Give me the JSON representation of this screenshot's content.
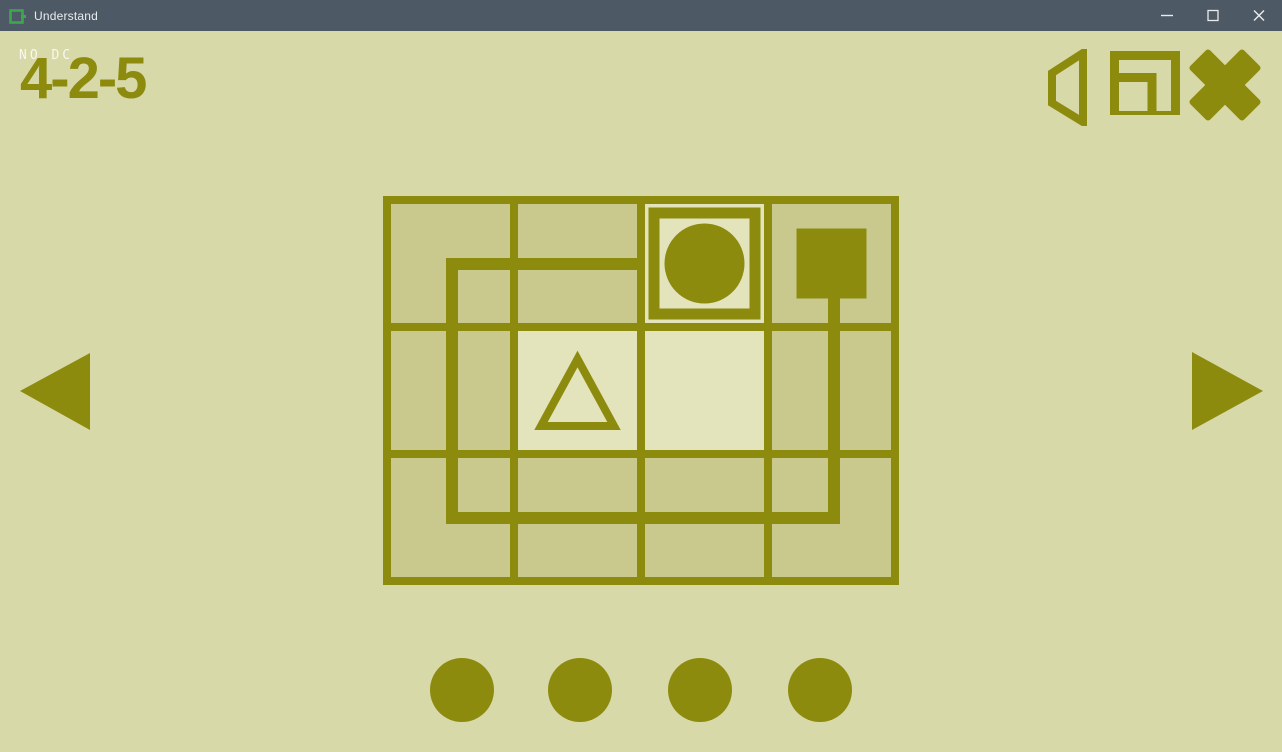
{
  "window": {
    "title": "Understand",
    "app_icon": "understand-logo-icon",
    "controls": [
      {
        "name": "minimize-button",
        "icon": "minimize-icon"
      },
      {
        "name": "maximize-button",
        "icon": "maximize-icon"
      },
      {
        "name": "close-button",
        "icon": "close-icon"
      }
    ]
  },
  "hud": {
    "puzzle_tag": "NO DC",
    "level_label": "4-2-5"
  },
  "toolbar_icons": [
    "speaker-icon",
    "window-mode-icon",
    "exit-icon"
  ],
  "nav": {
    "prev": "prev-arrow-icon",
    "next": "next-arrow-icon"
  },
  "colors": {
    "titlebar": "#4d5964",
    "title-text": "#e9ecee",
    "bg": "#d8d9a8",
    "olive": "#8c8b0e",
    "cell": "#c9c98e",
    "cell-light": "#e3e4bb",
    "logo-green": "#3fa54f"
  },
  "board": {
    "type": "grid-puzzle",
    "cols": 4,
    "rows": 3,
    "cell_px": 119,
    "border_px": 8,
    "width_px": 516,
    "height_px": 389,
    "light_cells": [
      [
        1,
        1
      ],
      [
        1,
        2
      ]
    ],
    "highlight_cell": [
      0,
      2
    ],
    "highlight_ring": {
      "x": 271,
      "y": 17,
      "size": 101,
      "stroke_px": 11
    },
    "path": {
      "stroke_px": 12,
      "points": "262,68 69,68 69,322 451,322 451,102"
    },
    "shapes": [
      {
        "kind": "circle",
        "cx": 321.5,
        "cy": 67.5,
        "r": 40,
        "filled": true
      },
      {
        "kind": "square",
        "x": 413.5,
        "y": 32.5,
        "size": 70,
        "filled": true
      },
      {
        "kind": "triangle",
        "points": "194.5,163 158,230 231,230",
        "filled": false,
        "stroke_px": 8
      }
    ]
  },
  "progress_dots": {
    "count": 4,
    "xs": [
      462,
      580,
      700,
      820
    ],
    "y": 659,
    "radius": 32
  }
}
